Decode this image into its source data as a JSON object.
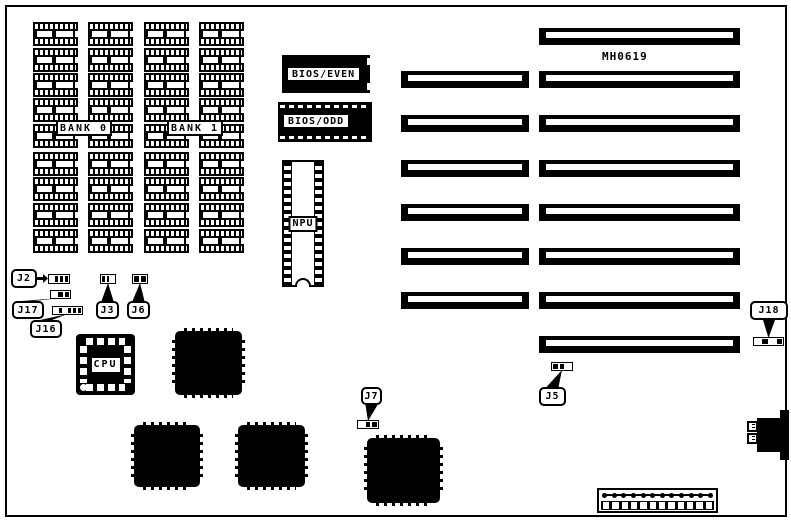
{
  "diagram": {
    "part_number": "MH0619",
    "part_number_pos": {
      "x": 602,
      "y": 50
    },
    "background_color": "#ffffff",
    "ink_color": "#000000"
  },
  "memory": {
    "chip_w": 45,
    "chip_h": 24,
    "col_xs": [
      33,
      88,
      144,
      199
    ],
    "row_ys": [
      22,
      48,
      73,
      98,
      124,
      152,
      177,
      203,
      229
    ],
    "bank_labels": [
      {
        "text": "BANK 0",
        "x": 56,
        "y": 120,
        "w": 56,
        "h": 16
      },
      {
        "text": "BANK 1",
        "x": 167,
        "y": 120,
        "w": 56,
        "h": 16
      }
    ]
  },
  "bios_chips": [
    {
      "text": "BIOS/EVEN",
      "style": "solid",
      "x": 282,
      "y": 55,
      "w": 88,
      "h": 38
    },
    {
      "text": "BIOS/ODD",
      "style": "dashed",
      "x": 278,
      "y": 102,
      "w": 94,
      "h": 40
    }
  ],
  "npu": {
    "text": "NPU",
    "x": 282,
    "y": 160,
    "w": 42,
    "h": 127
  },
  "slots": [
    {
      "type": "long",
      "x": 539,
      "y": 28,
      "w": 201,
      "h": 17
    },
    {
      "type": "long",
      "x": 539,
      "y": 71,
      "w": 201,
      "h": 17
    },
    {
      "type": "long",
      "x": 539,
      "y": 115,
      "w": 201,
      "h": 17
    },
    {
      "type": "long",
      "x": 539,
      "y": 160,
      "w": 201,
      "h": 17
    },
    {
      "type": "long",
      "x": 539,
      "y": 204,
      "w": 201,
      "h": 17
    },
    {
      "type": "long",
      "x": 539,
      "y": 248,
      "w": 201,
      "h": 17
    },
    {
      "type": "long",
      "x": 539,
      "y": 292,
      "w": 201,
      "h": 17
    },
    {
      "type": "long",
      "x": 539,
      "y": 336,
      "w": 201,
      "h": 17
    },
    {
      "type": "short",
      "x": 401,
      "y": 71,
      "w": 128,
      "h": 17
    },
    {
      "type": "short",
      "x": 401,
      "y": 115,
      "w": 128,
      "h": 17
    },
    {
      "type": "short",
      "x": 401,
      "y": 160,
      "w": 128,
      "h": 17
    },
    {
      "type": "short",
      "x": 401,
      "y": 204,
      "w": 128,
      "h": 17
    },
    {
      "type": "short",
      "x": 401,
      "y": 248,
      "w": 128,
      "h": 17
    },
    {
      "type": "short",
      "x": 401,
      "y": 292,
      "w": 128,
      "h": 17
    }
  ],
  "jumpers": [
    {
      "id": "J2",
      "dir": "right",
      "label": {
        "x": 11,
        "y": 269,
        "w": 26,
        "h": 19
      },
      "block": {
        "x": 48,
        "y": 274,
        "w": 22,
        "h": 10
      },
      "pins": [
        0,
        1,
        1,
        1
      ]
    },
    {
      "id": "J17",
      "dir": "up",
      "label": {
        "x": 12,
        "y": 301,
        "w": 32,
        "h": 18
      },
      "block": {
        "x": 50,
        "y": 290,
        "w": 21,
        "h": 9
      },
      "pins": [
        0,
        1,
        1
      ]
    },
    {
      "id": "J16",
      "dir": "up",
      "label": {
        "x": 30,
        "y": 320,
        "w": 32,
        "h": 18
      },
      "block": {
        "x": 52,
        "y": 306,
        "w": 31,
        "h": 9
      },
      "pins": [
        0,
        1,
        0,
        1,
        1,
        1
      ]
    },
    {
      "id": "J3",
      "dir": "up",
      "label": {
        "x": 96,
        "y": 301,
        "w": 23,
        "h": 18
      },
      "block": {
        "x": 100,
        "y": 274,
        "w": 16,
        "h": 10
      },
      "pins": [
        1,
        1,
        0
      ]
    },
    {
      "id": "J6",
      "dir": "up",
      "label": {
        "x": 127,
        "y": 301,
        "w": 23,
        "h": 18
      },
      "block": {
        "x": 132,
        "y": 274,
        "w": 16,
        "h": 10
      },
      "pins": [
        1,
        1
      ]
    },
    {
      "id": "J7",
      "dir": "down",
      "label": {
        "x": 361,
        "y": 387,
        "w": 21,
        "h": 18
      },
      "block": {
        "x": 357,
        "y": 420,
        "w": 22,
        "h": 9
      },
      "pins": [
        0,
        1,
        1
      ]
    },
    {
      "id": "J5",
      "dir": "up",
      "label": {
        "x": 539,
        "y": 387,
        "w": 27,
        "h": 19
      },
      "block": {
        "x": 551,
        "y": 362,
        "w": 22,
        "h": 9
      },
      "pins": [
        1,
        1,
        0
      ]
    },
    {
      "id": "J18",
      "dir": "down",
      "label": {
        "x": 750,
        "y": 301,
        "w": 38,
        "h": 19
      },
      "block": {
        "x": 753,
        "y": 337,
        "w": 31,
        "h": 9
      },
      "pins": [
        0,
        1,
        0,
        1
      ]
    }
  ],
  "cpu": {
    "text": "CPU",
    "x": 76,
    "y": 334,
    "w": 59,
    "h": 61
  },
  "qfp_chips": [
    {
      "x": 175,
      "y": 331,
      "w": 67,
      "h": 64
    },
    {
      "x": 134,
      "y": 425,
      "w": 66,
      "h": 62
    },
    {
      "x": 238,
      "y": 425,
      "w": 67,
      "h": 62
    },
    {
      "x": 367,
      "y": 438,
      "w": 73,
      "h": 65
    }
  ],
  "keyboard_connector": {
    "body": {
      "x": 757,
      "y": 418,
      "w": 24,
      "h": 34
    },
    "spine": {
      "x": 780,
      "y": 410,
      "w": 9,
      "h": 50
    },
    "plugs": [
      {
        "x": 747,
        "y": 421,
        "w": 11,
        "h": 11
      },
      {
        "x": 747,
        "y": 433,
        "w": 11,
        "h": 11
      }
    ]
  },
  "power_connector": {
    "x": 597,
    "y": 488,
    "w": 121,
    "h": 25,
    "pin_count": 12
  }
}
